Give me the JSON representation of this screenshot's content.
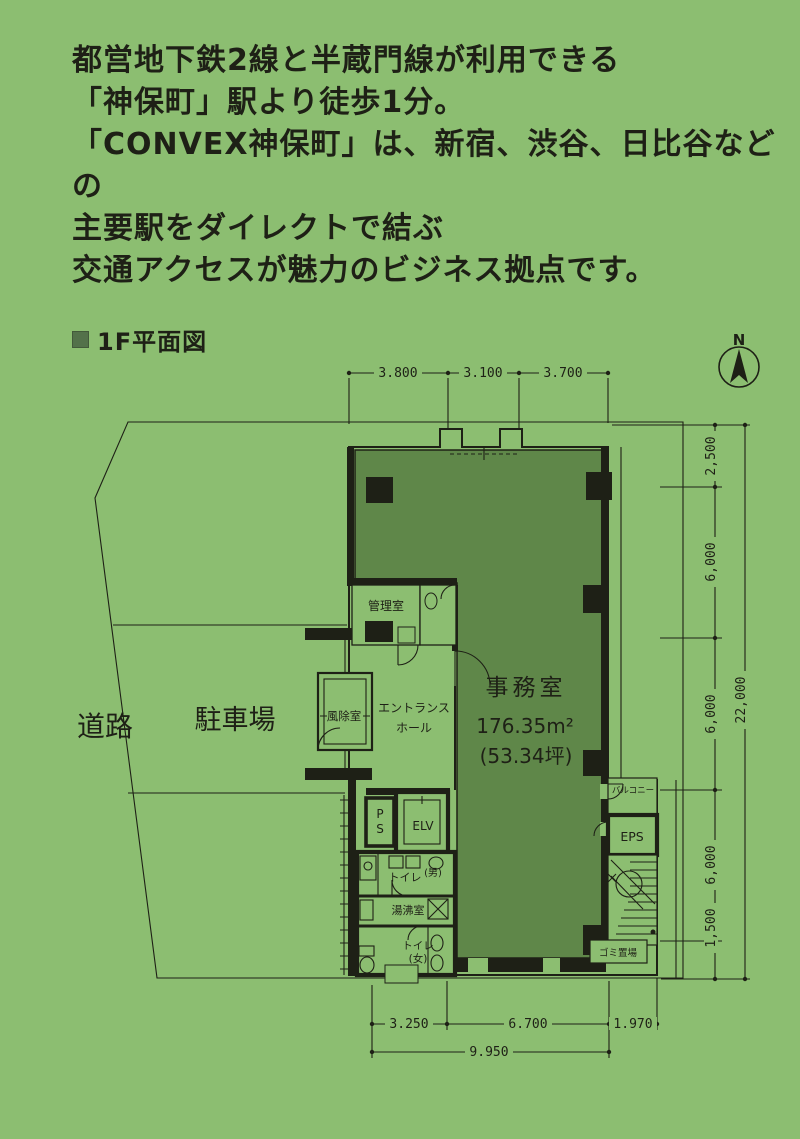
{
  "colors": {
    "background": "#8cbe71",
    "office_fill": "#5f8749",
    "ink": "#1e2016",
    "bullet": "#53714a"
  },
  "intro": {
    "lines": [
      "都営地下鉄2線と半蔵門線が利用できる",
      "「神保町」駅より徒歩1分。",
      "「CONVEX神保町」は、新宿、渋谷、日比谷などの",
      "主要駅をダイレクトで結ぶ",
      "交通アクセスが魅力のビジネス拠点です。"
    ]
  },
  "section": {
    "title": "1F平面図"
  },
  "compass": {
    "label": "N"
  },
  "plan": {
    "labels": {
      "road": "道路",
      "parking": "駐車場",
      "manager_room": "管理室",
      "windbreak_room": "風除室",
      "entrance_hall_1": "エントランス",
      "entrance_hall_2": "ホール",
      "office": "事務室",
      "office_area": "176.35m²",
      "office_tsubo": "(53.34坪)",
      "ps_p": "P",
      "ps_s": "S",
      "elevator": "ELV",
      "toilet_men": "トイレ",
      "toilet_men_tag": "(男)",
      "kitchenette": "湯沸室",
      "toilet_women": "トイレ",
      "toilet_women_tag": "(女)",
      "balcony": "バルコニー",
      "eps": "EPS",
      "garbage": "ゴミ置場"
    },
    "dims": {
      "top": [
        "3.800",
        "3.100",
        "3.700"
      ],
      "right": [
        "2,500",
        "6,000",
        "6,000",
        "6,000",
        "1,500"
      ],
      "right_total": "22,000",
      "bottom": [
        "3.250",
        "6.700",
        "1.970"
      ],
      "bottom_total": "9.950"
    }
  }
}
